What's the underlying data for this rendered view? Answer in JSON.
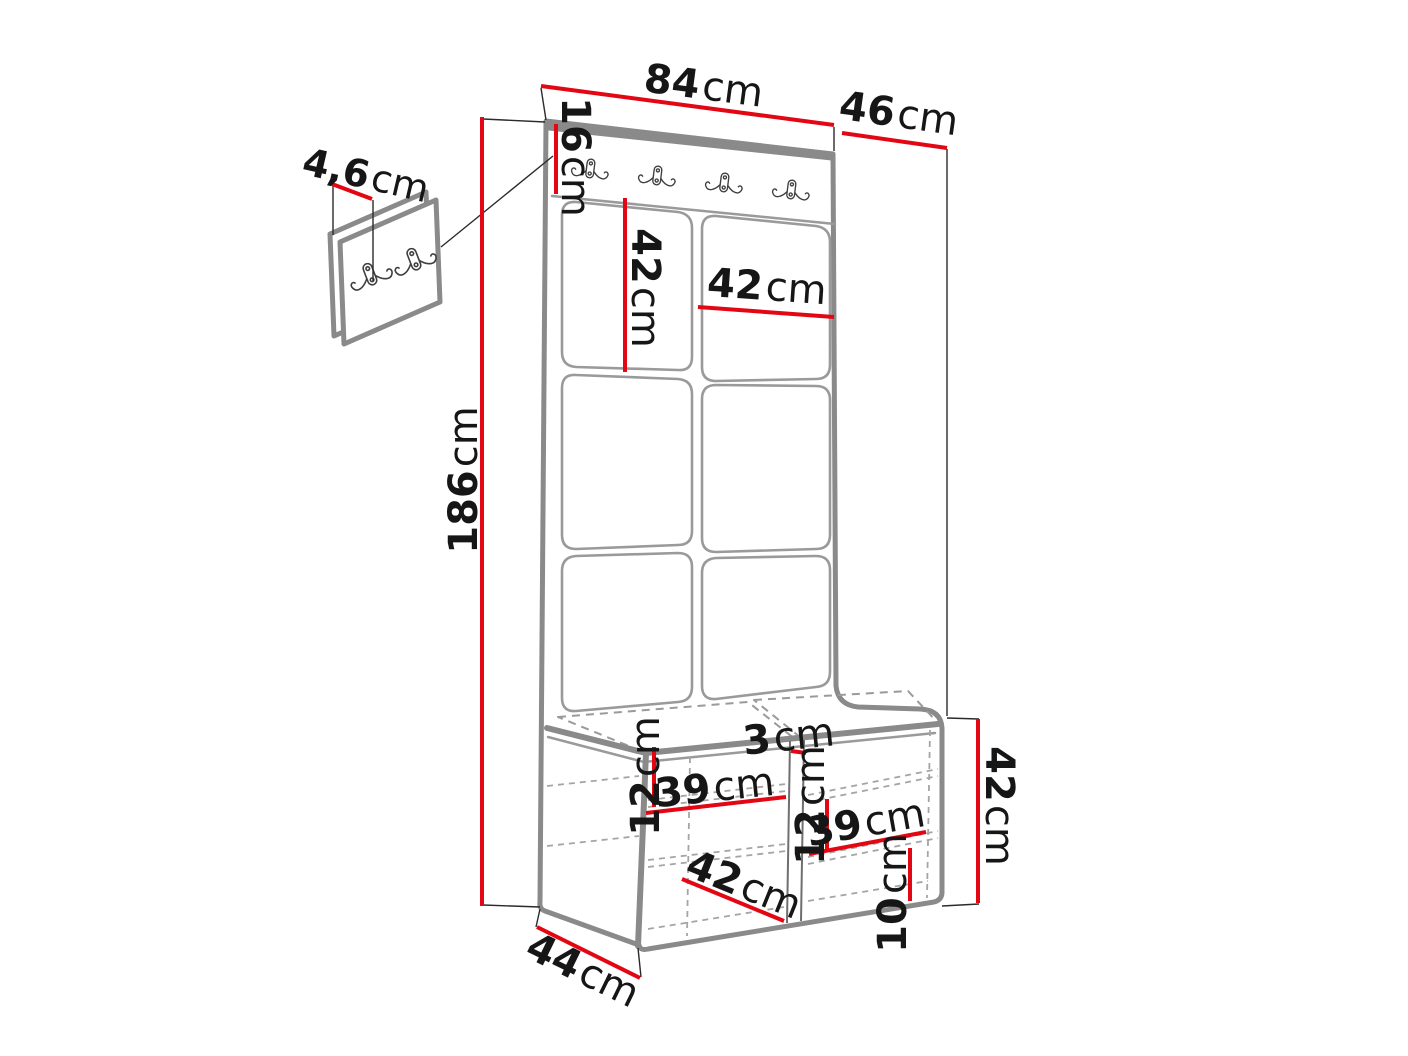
{
  "colors": {
    "dimension_red": "#e30613",
    "outline_gray": "#8a8a8a",
    "text_black": "#161616"
  },
  "icons": {
    "hook": "double-coat-hook-icon"
  },
  "dimensions": {
    "top_width": {
      "value": "84",
      "unit": "cm"
    },
    "top_depth": {
      "value": "46",
      "unit": "cm"
    },
    "hook_rail_height": {
      "value": "16",
      "unit": "cm"
    },
    "panel_tile_height": {
      "value": "42",
      "unit": "cm"
    },
    "panel_tile_width": {
      "value": "42",
      "unit": "cm"
    },
    "total_height": {
      "value": "186",
      "unit": "cm"
    },
    "wall_panel_size": {
      "value": "4,6",
      "unit": "cm"
    },
    "left_shelf_spacing": {
      "value": "12",
      "unit": "cm"
    },
    "left_shelf_depth": {
      "value": "39",
      "unit": "cm"
    },
    "center_divider": {
      "value": "3",
      "unit": "cm"
    },
    "right_shelf_spacing": {
      "value": "12",
      "unit": "cm"
    },
    "right_shelf_depth": {
      "value": "39",
      "unit": "cm"
    },
    "bench_compartment_width": {
      "value": "42",
      "unit": "cm"
    },
    "plinth_height": {
      "value": "10",
      "unit": "cm"
    },
    "bench_depth": {
      "value": "44",
      "unit": "cm"
    },
    "bench_height": {
      "value": "42",
      "unit": "cm"
    }
  }
}
